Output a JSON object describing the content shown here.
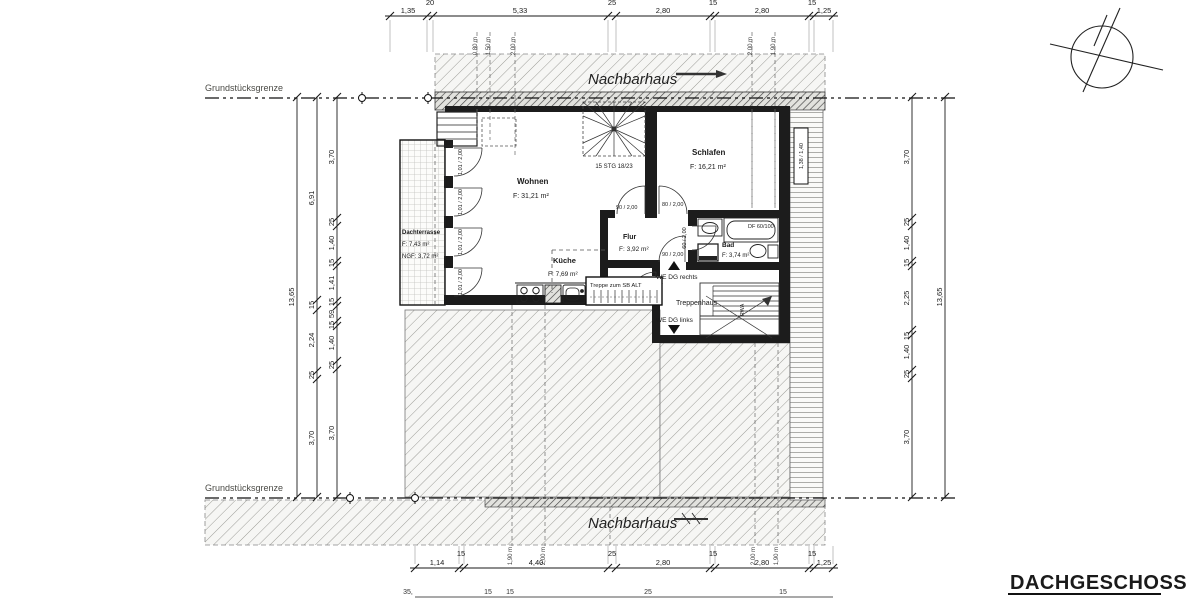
{
  "title": "DACHGESCHOSS",
  "site": {
    "boundary_top": "Grundstücksgrenze",
    "boundary_bottom": "Grundstücksgrenze",
    "neighbor_top": "Nachbarhaus",
    "neighbor_bottom": "Nachbarhaus"
  },
  "rooms": {
    "wohnen": {
      "name": "Wohnen",
      "area": "F: 31,21 m²"
    },
    "schlafen": {
      "name": "Schlafen",
      "area": "F: 16,21 m²"
    },
    "flur": {
      "name": "Flur",
      "area": "F: 3,92 m²"
    },
    "kueche": {
      "name": "Küche",
      "area": "F: 7,69 m²"
    },
    "bad": {
      "name": "Bad",
      "area": "F: 3,74 m²"
    },
    "treppenhaus": {
      "name": "Treppenhaus"
    },
    "dachterrasse": {
      "name": "Dachterrasse",
      "area": "F:    7,43 m²",
      "ngf": "NGF: 3,72 m²"
    }
  },
  "stairs": {
    "spiral": "15 STG 18/23",
    "attic": "Treppe zum SB ALT",
    "rwa": "RWA"
  },
  "units": {
    "right": "WE DG rechts",
    "left": "WE DG links"
  },
  "openings": {
    "terrace_door": "1,01 / 2,00",
    "flur_door": "90 / 2,00",
    "schlafen_door": "80 / 2,00",
    "bad_door": "60 / 2,00",
    "we_right_door": "90 / 2,00",
    "we_left_door": "90 / 2,00",
    "roof_window": "DF 60/100",
    "side_window": "1,38 / 1,40"
  },
  "heights": {
    "top": [
      "0,80 m",
      "1,50 m",
      "2,00 m",
      "2,00 m",
      "1,90 m"
    ],
    "bottom": [
      "1,90 m",
      "2,00 m",
      "2,00 m",
      "1,90 m"
    ]
  },
  "dims": {
    "top": [
      "1,35",
      "20",
      "5,33",
      "25",
      "2,80",
      "15",
      "2,80",
      "15",
      "1,25"
    ],
    "bottom": [
      "1,14",
      "15",
      "4,40",
      "25",
      "2,80",
      "15",
      "2,80",
      "15",
      "1,25"
    ],
    "bottom2": [
      "35,",
      "15",
      "15",
      "25",
      "15"
    ],
    "left_outer": "13,65",
    "left_mid": [
      "6,91",
      "15",
      "2,24",
      "25",
      "3,70"
    ],
    "left_inner": [
      "3,70",
      "25",
      "1,40",
      "15",
      "1,41",
      "15",
      "59",
      "15",
      "1,40",
      "25",
      "3,70"
    ],
    "right_inner": [
      "3,70",
      "25",
      "1,40",
      "15",
      "2,25",
      "15",
      "1,40",
      "25",
      "3,70"
    ],
    "right_outer": "13,65"
  }
}
